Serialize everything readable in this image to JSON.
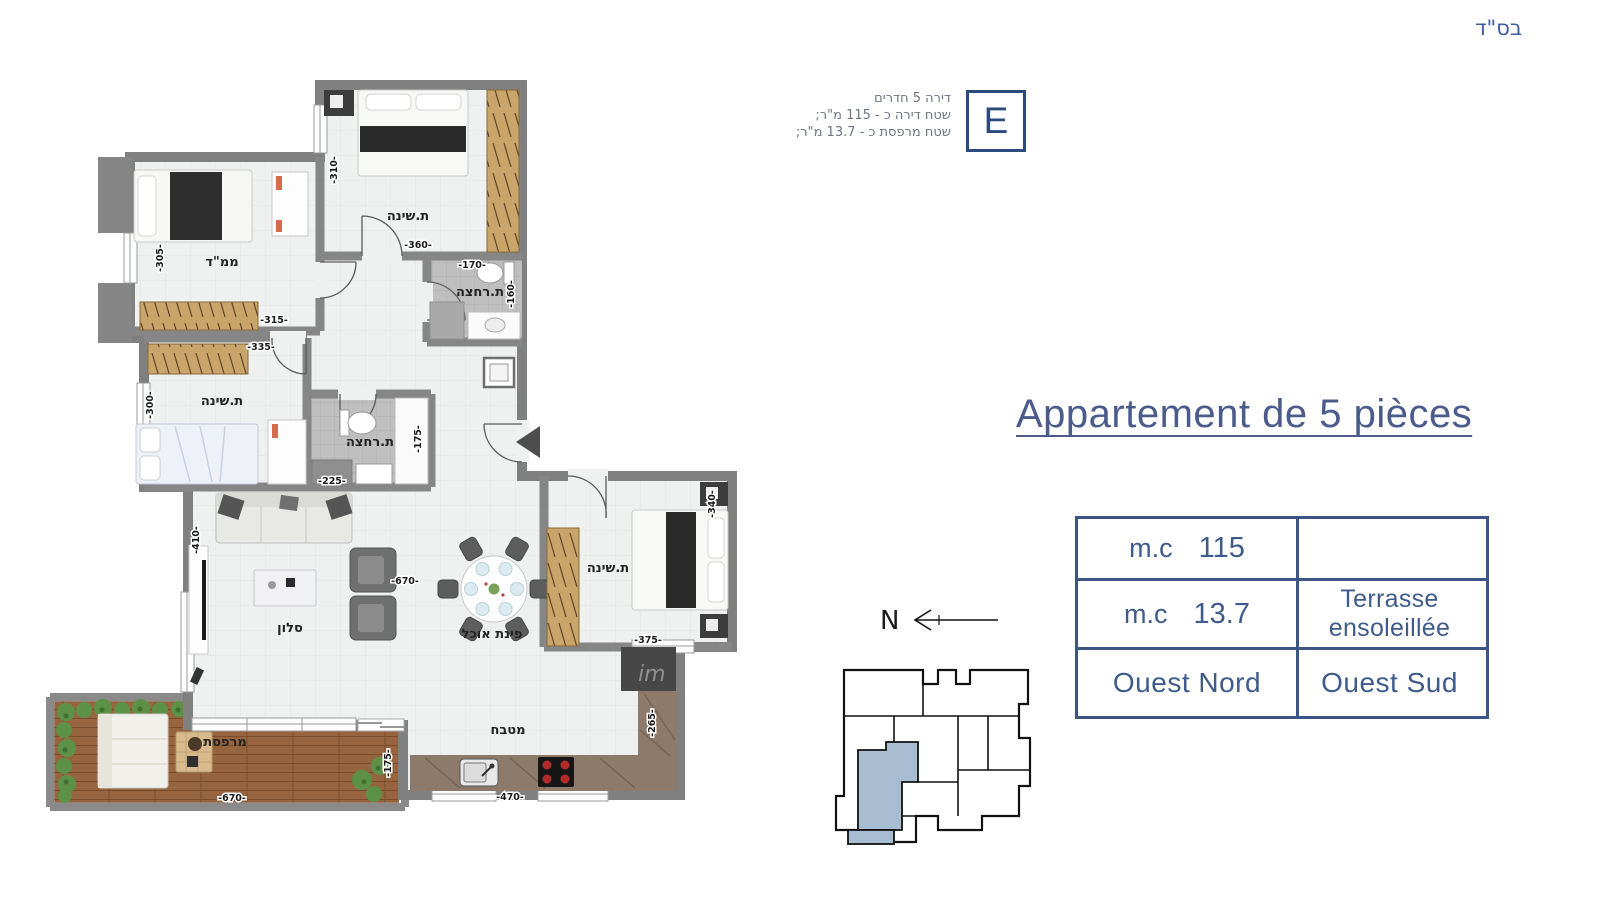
{
  "header": {
    "bsd": "בס\"ד"
  },
  "unit_badge": {
    "letter": "E"
  },
  "unit_info": {
    "line1": "דירה 5 חדרים",
    "line2": "שטח דירה כ - 115 מ\"ר;",
    "line3": "שטח מרפסת כ - 13.7 מ\"ר;"
  },
  "title": {
    "text": "Appartement de 5 pièces"
  },
  "spec_table": {
    "r1c1_label": "m.c",
    "r1c1_value": "115",
    "r1c2": "",
    "r2c1_label": "m.c",
    "r2c1_value": "13.7",
    "r2c2_line1": "Terrasse",
    "r2c2_line2": "ensoleillée",
    "r3c1": "Ouest Nord",
    "r3c2": "Ouest Sud"
  },
  "compass": {
    "label": "N"
  },
  "plan": {
    "rooms": {
      "bedroom_top": "ת.שינה",
      "mamad": "ממ\"ד",
      "bath_top": "ת.רחצה",
      "bedroom_left": "ת.שינה",
      "bath_mid": "ת.רחצה",
      "salon": "סלון",
      "dining": "פינת אוכל",
      "bedroom_right": "ת.שינה",
      "kitchen": "מטבח",
      "terrace": "מרפסת"
    },
    "dims": [
      "-310-",
      "-360-",
      "-170-",
      "-160-",
      "-305-",
      "-315-",
      "-335-",
      "-300-",
      "-225-",
      "-175-",
      "-410-",
      "-670-",
      "-340-",
      "-375-",
      "-265-",
      "-470-",
      "-670-",
      "-175-"
    ],
    "watermark": "im"
  },
  "colors": {
    "accent": "#3b5684",
    "wall": "#858585",
    "highlight_unit": "#a8bcd2"
  }
}
